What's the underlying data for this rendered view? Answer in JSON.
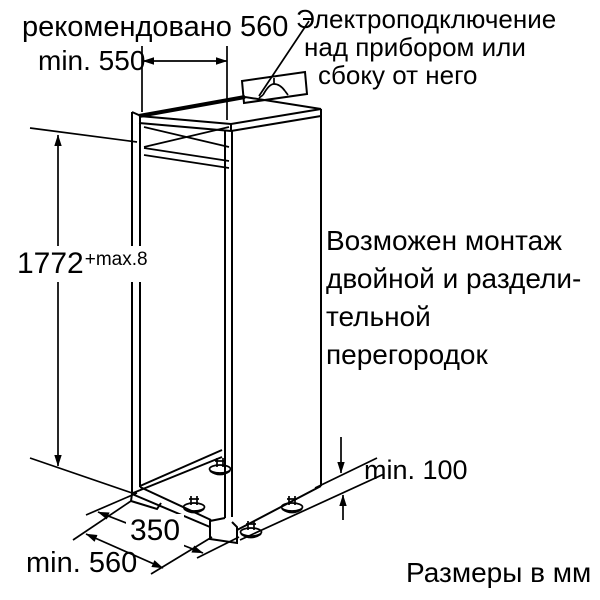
{
  "page": {
    "background_color": "#ffffff",
    "line_color": "#000000"
  },
  "dimensions": {
    "top_recommended": "рекомендовано 560",
    "top_min": "min. 550",
    "height": "1772",
    "height_tolerance": "+max.8",
    "bottom_inner": "350",
    "bottom_min": "min. 560",
    "side_min": "min. 100"
  },
  "notes": {
    "electrical_line1": "Электроподключение",
    "electrical_line2": "над прибором или",
    "electrical_line3": "сбоку от него",
    "partition_line1": "Возможен монтаж",
    "partition_line2": "двойной и раздели-",
    "partition_line3": "тельной",
    "partition_line4": "перегородок",
    "units": "Размеры в мм"
  },
  "icons": {
    "outlet": "socket-outlet-symbol"
  }
}
